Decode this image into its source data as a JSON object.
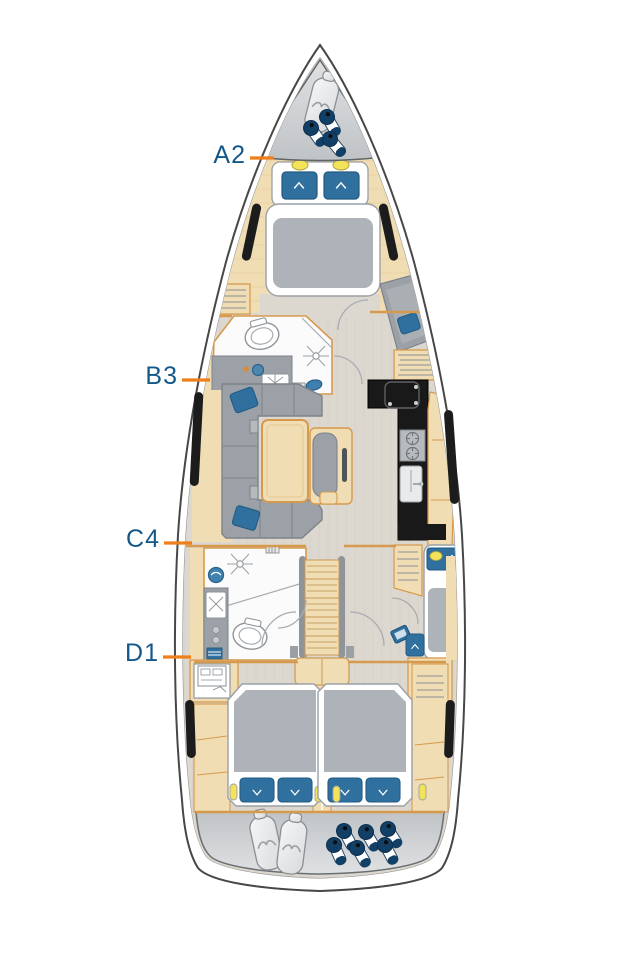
{
  "labels": [
    {
      "text": "A2",
      "section": "fore-cabin"
    },
    {
      "text": "B3",
      "section": "salon-and-galley"
    },
    {
      "text": "C4",
      "section": "aft-head-and-nav-cabin"
    },
    {
      "text": "D1",
      "section": "aft-cabins"
    }
  ],
  "icons": {
    "sail-bag": "rounded-bag-shape-with-wave-logo",
    "fender": "navy-cylinder-with-white-band",
    "toilet": "oval-bowl-glyph",
    "shower-drain": "radial-lines-glyph",
    "stove-burner": "circle-with-ticks",
    "faucet": "starburst-glyph",
    "reading-light": "yellow-pill",
    "brand-logo": "white-chevron-wave"
  },
  "colors": {
    "label_text": "#14588a",
    "leader_line": "#ee7f1b",
    "hull_outline": "#474747",
    "hull_inner_line": "#9a9a9a",
    "floor": "#ddd8cf",
    "floor_grain": "#ccc6bb",
    "wood": "#f0ddb4",
    "wood_edge": "#d69a4e",
    "furniture_gray": "#9ba1a6",
    "furniture_gray_dark": "#7d8388",
    "mattress_gray": "#adb3b8",
    "cushion_blue": "#30709f",
    "cushion_blue_dark": "#215a80",
    "window_black": "#1c1c1c",
    "galley_black": "#191919",
    "locker_silver": "#c0c3c6",
    "locker_silver_light": "#dfe1e3",
    "fender_navy": "#123f66",
    "light_yellow": "#f3e35a",
    "white_fixture": "#fbfbfb"
  }
}
